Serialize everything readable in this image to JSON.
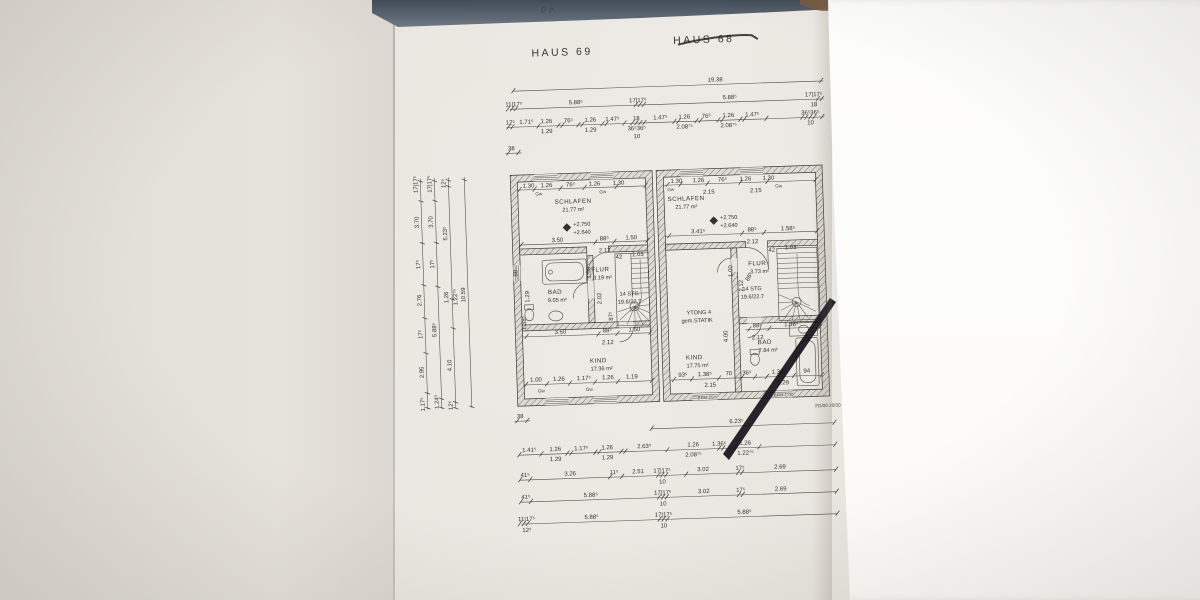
{
  "header": {
    "haus_left": "HAUS 69",
    "haus_right": "HAUS 68",
    "handwriting": "0·7·"
  },
  "rooms": {
    "schlafen_l": {
      "name": "SCHLAFEN",
      "area": "21.77 m²"
    },
    "schlafen_r": {
      "name": "SCHLAFEN",
      "area": "21.77 m²"
    },
    "bad_l": {
      "name": "BAD",
      "area": "9.05 m²"
    },
    "bad_r": {
      "name": "BAD",
      "area": "7.84 m²"
    },
    "flur_l": {
      "name": "FLUR",
      "area": "3.19 m²"
    },
    "flur_r": {
      "name": "FLUR",
      "area": "3.73 m²"
    },
    "kind_l": {
      "name": "KIND",
      "area": "17.36 m²"
    },
    "kind_r": {
      "name": "KIND",
      "area": "17.75 m²"
    }
  },
  "stairs": {
    "l1": "14 STG",
    "l2": "19.6/22.7"
  },
  "levels": {
    "upper": "+2.750",
    "lower": "+2.640"
  },
  "notes": {
    "fd": "FD/00 20/30",
    "ytong1": "YTONG 4",
    "ytong2": "gem.STATIK",
    "brh25": "BRH 25",
    "brh100": "BRH 1.00",
    "gw": "Gw"
  },
  "dims": {
    "top_total": "19.38",
    "top_row2": [
      "11|17⁵",
      "5.88⁵",
      "17|17⁵",
      "5.88⁵",
      "17|17⁵",
      "18"
    ],
    "top_row3": [
      "12⁵",
      "1.71⁵",
      "1.26",
      "76⁵",
      "1.26",
      "1.47⁵",
      "18",
      "1.47⁵",
      "1.26",
      "76⁵",
      "1.26",
      "1.47⁵",
      "36⁵36⁵"
    ],
    "top_row3_sub": [
      "1.29",
      "1.29",
      "36⁵36⁵",
      "10",
      "2.08⁷⁵",
      "2.08⁷⁵",
      "10"
    ],
    "top_38": "38",
    "left_total": "10.59",
    "left_c1": [
      "17|17⁵",
      "3.70",
      "17⁵",
      "2.76",
      "17⁵",
      "2.95",
      "1.17⁵"
    ],
    "left_c2": [
      "17|17⁵",
      "3.70",
      "17⁵",
      "5.88⁵",
      "1.24⁵"
    ],
    "left_c3": [
      "12⁵",
      "5.23⁵",
      "1.26",
      "1.22⁷⁵",
      "4.10",
      "12⁵"
    ],
    "bottom_38": "38",
    "bottom_623": "6.23⁵",
    "bottom_row1": [
      "1.41⁵",
      "1.26",
      "1.17⁵",
      "1.26",
      "2.63⁵",
      "1.26",
      "1.36⁵",
      "1.26"
    ],
    "bottom_row1_sub": [
      "1.29",
      "1.29",
      "2.08⁷⁵",
      "1.22⁷⁵"
    ],
    "bottom_row2": [
      "41⁵",
      "3.26",
      "11⁵",
      "2.51",
      "17|17⁵",
      "3.02",
      "17⁵",
      "2.69"
    ],
    "bottom_row2_sub": "10",
    "bottom_row3": [
      "41⁵",
      "5.88⁵",
      "17|17⁵",
      "3.02",
      "17⁵",
      "2.69"
    ],
    "bottom_row3_sub": "10",
    "bottom_row4": [
      "11|17⁵",
      "5.88⁵",
      "17|17⁵",
      "5.88⁵"
    ],
    "bottom_row4_sub": [
      "12⁵",
      "10"
    ],
    "ul_top": [
      "1.30",
      "1.26",
      "76⁵",
      "1.26",
      "1.30"
    ],
    "ul_mid": [
      "3.50",
      "88⁵",
      "1.50"
    ],
    "ul_mid2": "2.12",
    "ul_door": [
      "42",
      "1.03"
    ],
    "ul_low": [
      "3.50",
      "88⁵",
      "1.50"
    ],
    "ul_low2": "2.12",
    "ul_bottom": [
      "1.00",
      "1.26",
      "1.17⁵",
      "1.26",
      "1.19"
    ],
    "ul_v": [
      "88",
      "1.29",
      "1.38⁵",
      "1.00",
      "2.02",
      "87⁵"
    ],
    "ur_top": [
      "1.30",
      "1.26",
      "76⁵",
      "1.26",
      "1.30"
    ],
    "ur_top2": [
      "2.15",
      "2.15"
    ],
    "ur_mid": [
      "3.41⁵",
      "88⁵",
      "1.58⁵"
    ],
    "ur_mid2": "2.12",
    "ur_door": [
      "42",
      "1.03"
    ],
    "ur_low": [
      "88⁵",
      "1.38⁵"
    ],
    "ur_low2": "2.12",
    "ur_bottom": [
      "93⁵",
      "1.38⁵",
      "70",
      "36⁵",
      "1.38⁵",
      "94"
    ],
    "ur_bottom2": [
      "2.15",
      "1.29"
    ],
    "ur_v": [
      "1.00",
      "2.12",
      "88⁵",
      "4.00"
    ]
  }
}
